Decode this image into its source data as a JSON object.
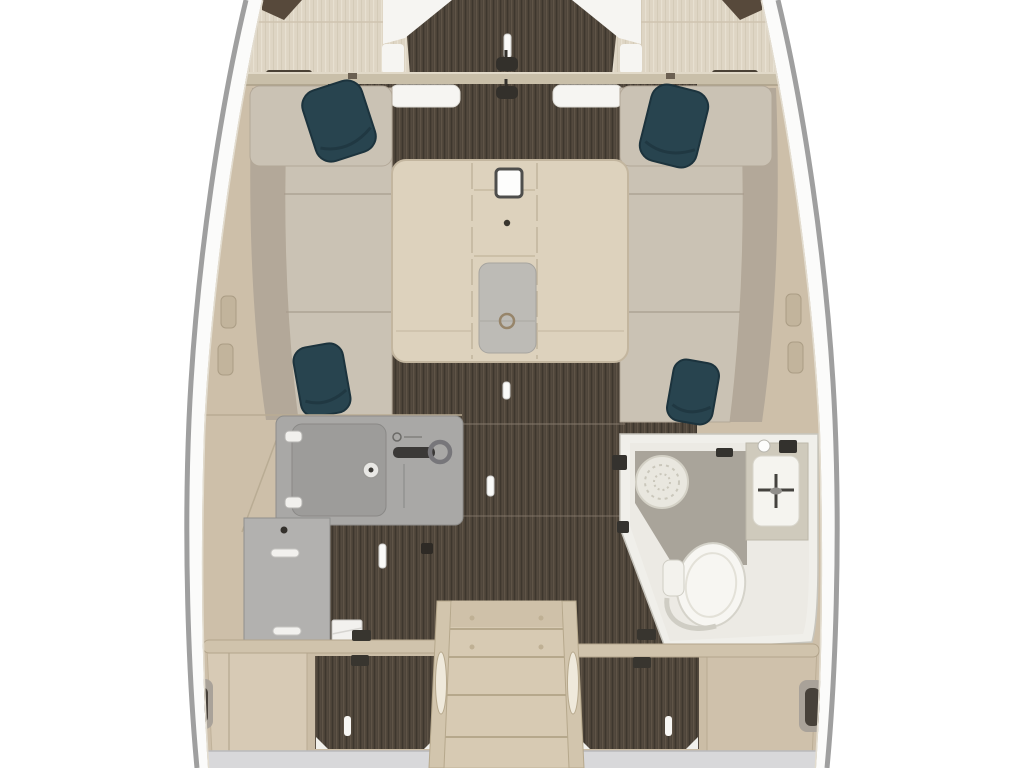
{
  "page": {
    "title": "Sailboat interior floor plan — top-down rendering",
    "description": "3D-rendered deck plan of a sailing yacht salon: U-shaped settee with table, galley, head compartment with toilet shower and washbasin, companionway steps aft, dark wood plank flooring",
    "visible_text": ""
  },
  "palette": {
    "bg": "#ffffff",
    "hull_line": "#9f9f9f",
    "hull_deck": "#fbfbfa",
    "panel_beige": "#cdbfa9",
    "panel_beige_light": "#d7cab5",
    "bow_wood": "#ded5c4",
    "floor_dark": "#4c4338",
    "floor_streak": "#6e6253",
    "floor_deep": "#352e26",
    "cushion": "#cac2b4",
    "cushion_dark": "#b3a899",
    "pillow": "#28444f",
    "pillow_dark": "#1c333d",
    "table_wood": "#ddd2bd",
    "table_panel": "#bdbbb6",
    "seam": "#b6a88c",
    "counter_gray": "#a9a8a6",
    "counter_dark": "#9d9c9a",
    "cabinet_gray": "#b2b1af",
    "white_trim": "#f6f5f2",
    "bath_wall": "#f0efea",
    "bath_floor": "#eceae4",
    "bath_mat": "#a9a49a",
    "toilet_white": "#f7f6f2",
    "stair_wood": "#d7cab3",
    "bottom_gray": "#d8d8da"
  },
  "components": {
    "hull": "tapered white hull outline, bow at top",
    "bow": [
      "port storage recess",
      "starboard storage recess",
      "forward cabin dark-wood sole",
      "bulkhead beam with two dark latch handles",
      "white hatch trims"
    ],
    "salon": {
      "settees": [
        "forward bench port",
        "forward bench starboard",
        "side bench port (3 cushions)",
        "side bench starboard (3 cushions)"
      ],
      "throw_pillows": 4,
      "table": [
        "folding leaves with seam lines",
        "white square fitting",
        "center pin",
        "grey inlay panel with emblem"
      ]
    },
    "galley": [
      "L-shaped grey countertop",
      "stove lid with hinges and knob",
      "sink with dark faucet lever",
      "lower cabinet with two handle slots",
      "white locker box on sole"
    ],
    "head": [
      "white-walled compartment",
      "shower drain rosette",
      "grey shower mat",
      "toilet",
      "washbasin with cross faucet",
      "door hinges"
    ],
    "aft": [
      "companionway steps with oval handrail cutouts",
      "port grab rail",
      "starboard grab rail",
      "two dark-wood floor hatches with white lights",
      "berth side panels with recessed handles",
      "grey transom step"
    ]
  },
  "floor_lights": 6
}
